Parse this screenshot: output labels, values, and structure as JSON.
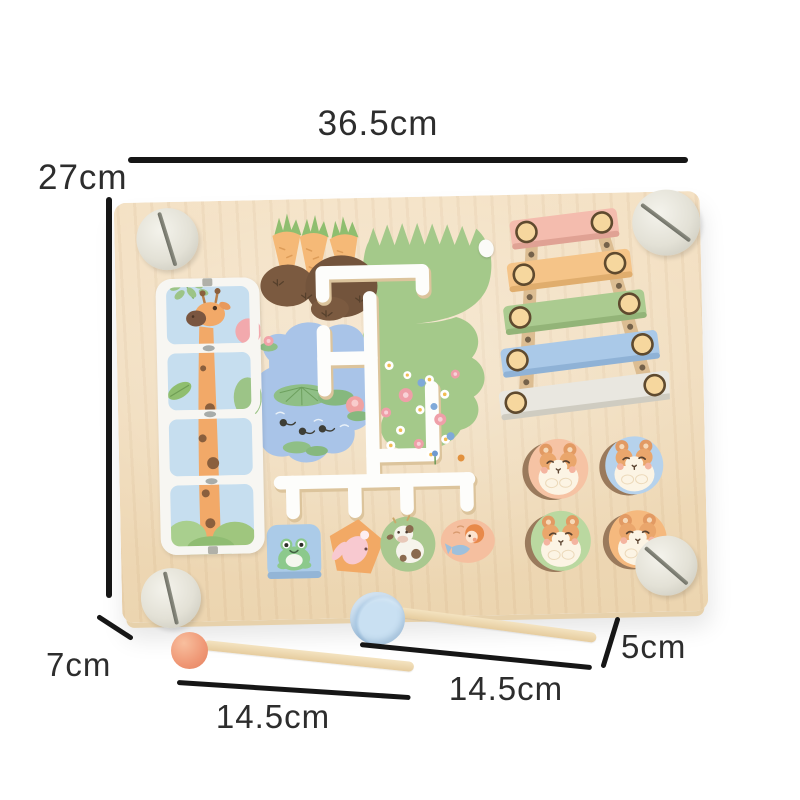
{
  "dimensions": {
    "board_width": "36.5cm",
    "board_height": "27cm",
    "board_thickness": "7cm",
    "ball_mallet_length": "14.5cm",
    "drum_mallet_length": "14.5cm",
    "drum_mallet_head": "5cm"
  },
  "palette": {
    "dimension_line": "#161616",
    "label_text": "#2d2d2d",
    "board_wood": "#f2ddbd",
    "track_white": "#fdfdfb",
    "pond_blue": "#a9c4e8",
    "grass_green": "#a4c98a",
    "carrot_orange": "#f5b977",
    "dirt_brown": "#7b5a40",
    "screw_cream": "#e4e2d7",
    "xylo_pink": "#f4bcae",
    "xylo_orange": "#f5c488",
    "xylo_green": "#abcb90",
    "xylo_blue": "#aac9e8",
    "xylo_white": "#e9e7e0",
    "knob_cream": "#f6d79e",
    "hamster_peach": "#f6c3a4",
    "hamster_blue": "#b6d2ec",
    "hamster_green": "#bad8a0",
    "hamster_orange": "#f5b97e",
    "slider_blue": "#abcbe8",
    "slider_orange": "#f2a965",
    "slider_green": "#a9c88f",
    "slider_peach": "#f5bf9f",
    "mallet_ball": "#ef9775",
    "mallet_head_blue": "#b9d6ec",
    "stick_wood": "#eedcb4"
  },
  "parts": [
    "corner-screws",
    "giraffe-slide-puzzle",
    "carrot-patch",
    "grass-and-flower-meadow",
    "pond-with-lilypads",
    "white-maze-track",
    "xylophone",
    "hamster-pegs",
    "animal-sliders",
    "ball-mallet",
    "drum-mallet"
  ]
}
